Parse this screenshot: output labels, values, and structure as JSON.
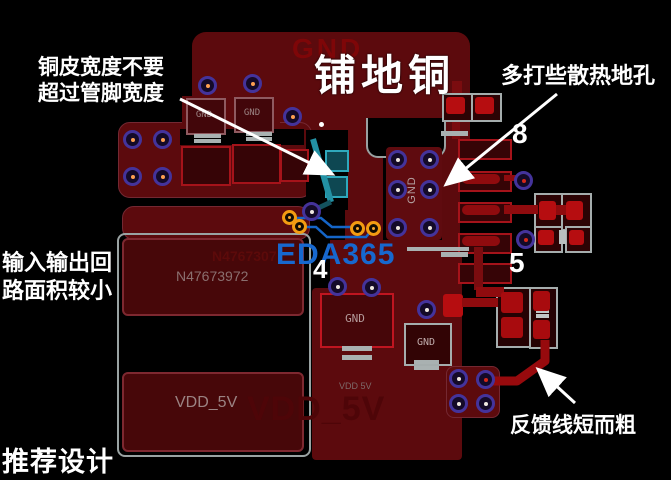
{
  "annotations": {
    "copper_width_line1": "铜皮宽度不要",
    "copper_width_line2": "超过管脚宽度",
    "pour_label": "铺地铜",
    "thermal_vias": "多打些散热地孔",
    "io_loop_line1": "输入输出回",
    "io_loop_line2": "路面积较小",
    "feedback": "反馈线短而粗",
    "recommended": "推荐设计"
  },
  "watermarks": {
    "eda365": "EDA365",
    "gnd_ghost": "GND",
    "vdd_ghost": "VDD_5V",
    "part_ghost": "N4767307"
  },
  "labels": {
    "gnd": "GND",
    "part_number": "N47673972",
    "vdd_5v": "VDD_5V",
    "vdd_5v_small": "VDD 5V",
    "pin_8": "8",
    "pin_5": "5",
    "pin_4": "4"
  },
  "colors": {
    "background": "#000000",
    "copper": "#5c0a0d",
    "pad_outline_red": "#a5131a",
    "bright_red": "#b60d10",
    "silkscreen_gray": "#a5adad",
    "via_ring_purple": "#44339b",
    "via_ring_orange": "#f39c12",
    "teal_trace": "#2391a4",
    "logo_blue": "#1565c8",
    "ghost_red": "#7e0608",
    "annotation_white": "#ffffff"
  }
}
